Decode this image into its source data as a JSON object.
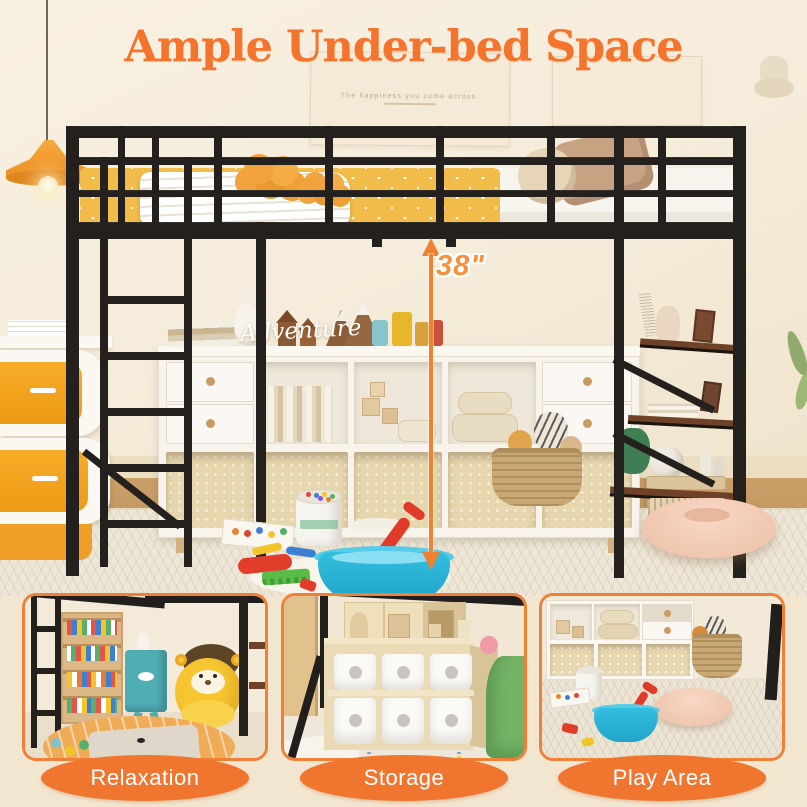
{
  "title": "Ample Under-bed Space",
  "measurement": {
    "label": "38\""
  },
  "scene": {
    "wall_decal_text": "Adventure",
    "poster_text": "The happiness you come across."
  },
  "panels": [
    {
      "id": "relaxation",
      "label": "Relaxation"
    },
    {
      "id": "storage",
      "label": "Storage"
    },
    {
      "id": "play-area",
      "label": "Play Area"
    }
  ],
  "colors": {
    "accent_orange": "#F0762F",
    "panel_border_orange": "#F08038",
    "title_orange": "#F4742C",
    "frame_black": "#23201D",
    "bedding_yellow": "#F1BC4A",
    "wall_cream": "#F5ECDB",
    "page_cream": "#F3E6D0",
    "label_text_white": "#FFFFFF"
  }
}
